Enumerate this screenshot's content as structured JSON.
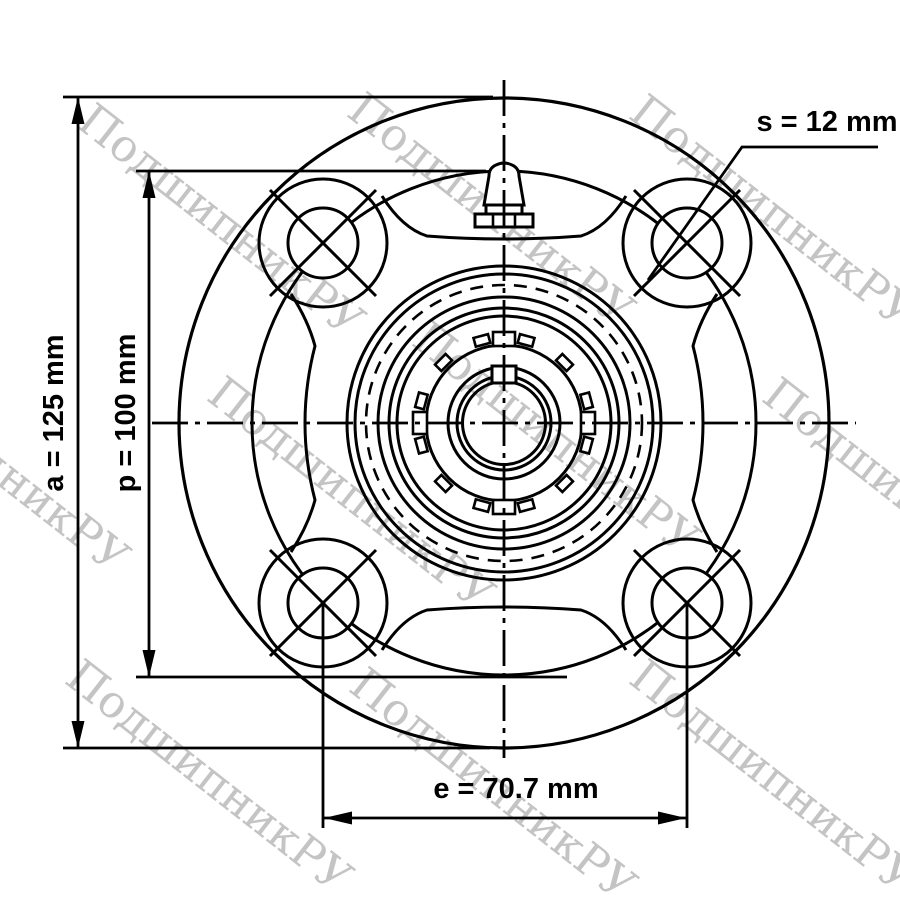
{
  "watermark": {
    "text": "ПодшипникРУ",
    "color": "#c4c4c4"
  },
  "dimensions": {
    "a": {
      "name": "a",
      "label": "a = 125 mm",
      "value": "125",
      "unit": "mm"
    },
    "p": {
      "name": "p",
      "label": "p = 100 mm",
      "value": "100",
      "unit": "mm"
    },
    "s": {
      "name": "s",
      "label": "s = 12 mm",
      "value": "12",
      "unit": "mm"
    },
    "e": {
      "name": "e",
      "label": "e = 70.7 mm",
      "value": "70.7",
      "unit": "mm"
    }
  },
  "colors": {
    "line": "#000000",
    "background": "#ffffff"
  }
}
